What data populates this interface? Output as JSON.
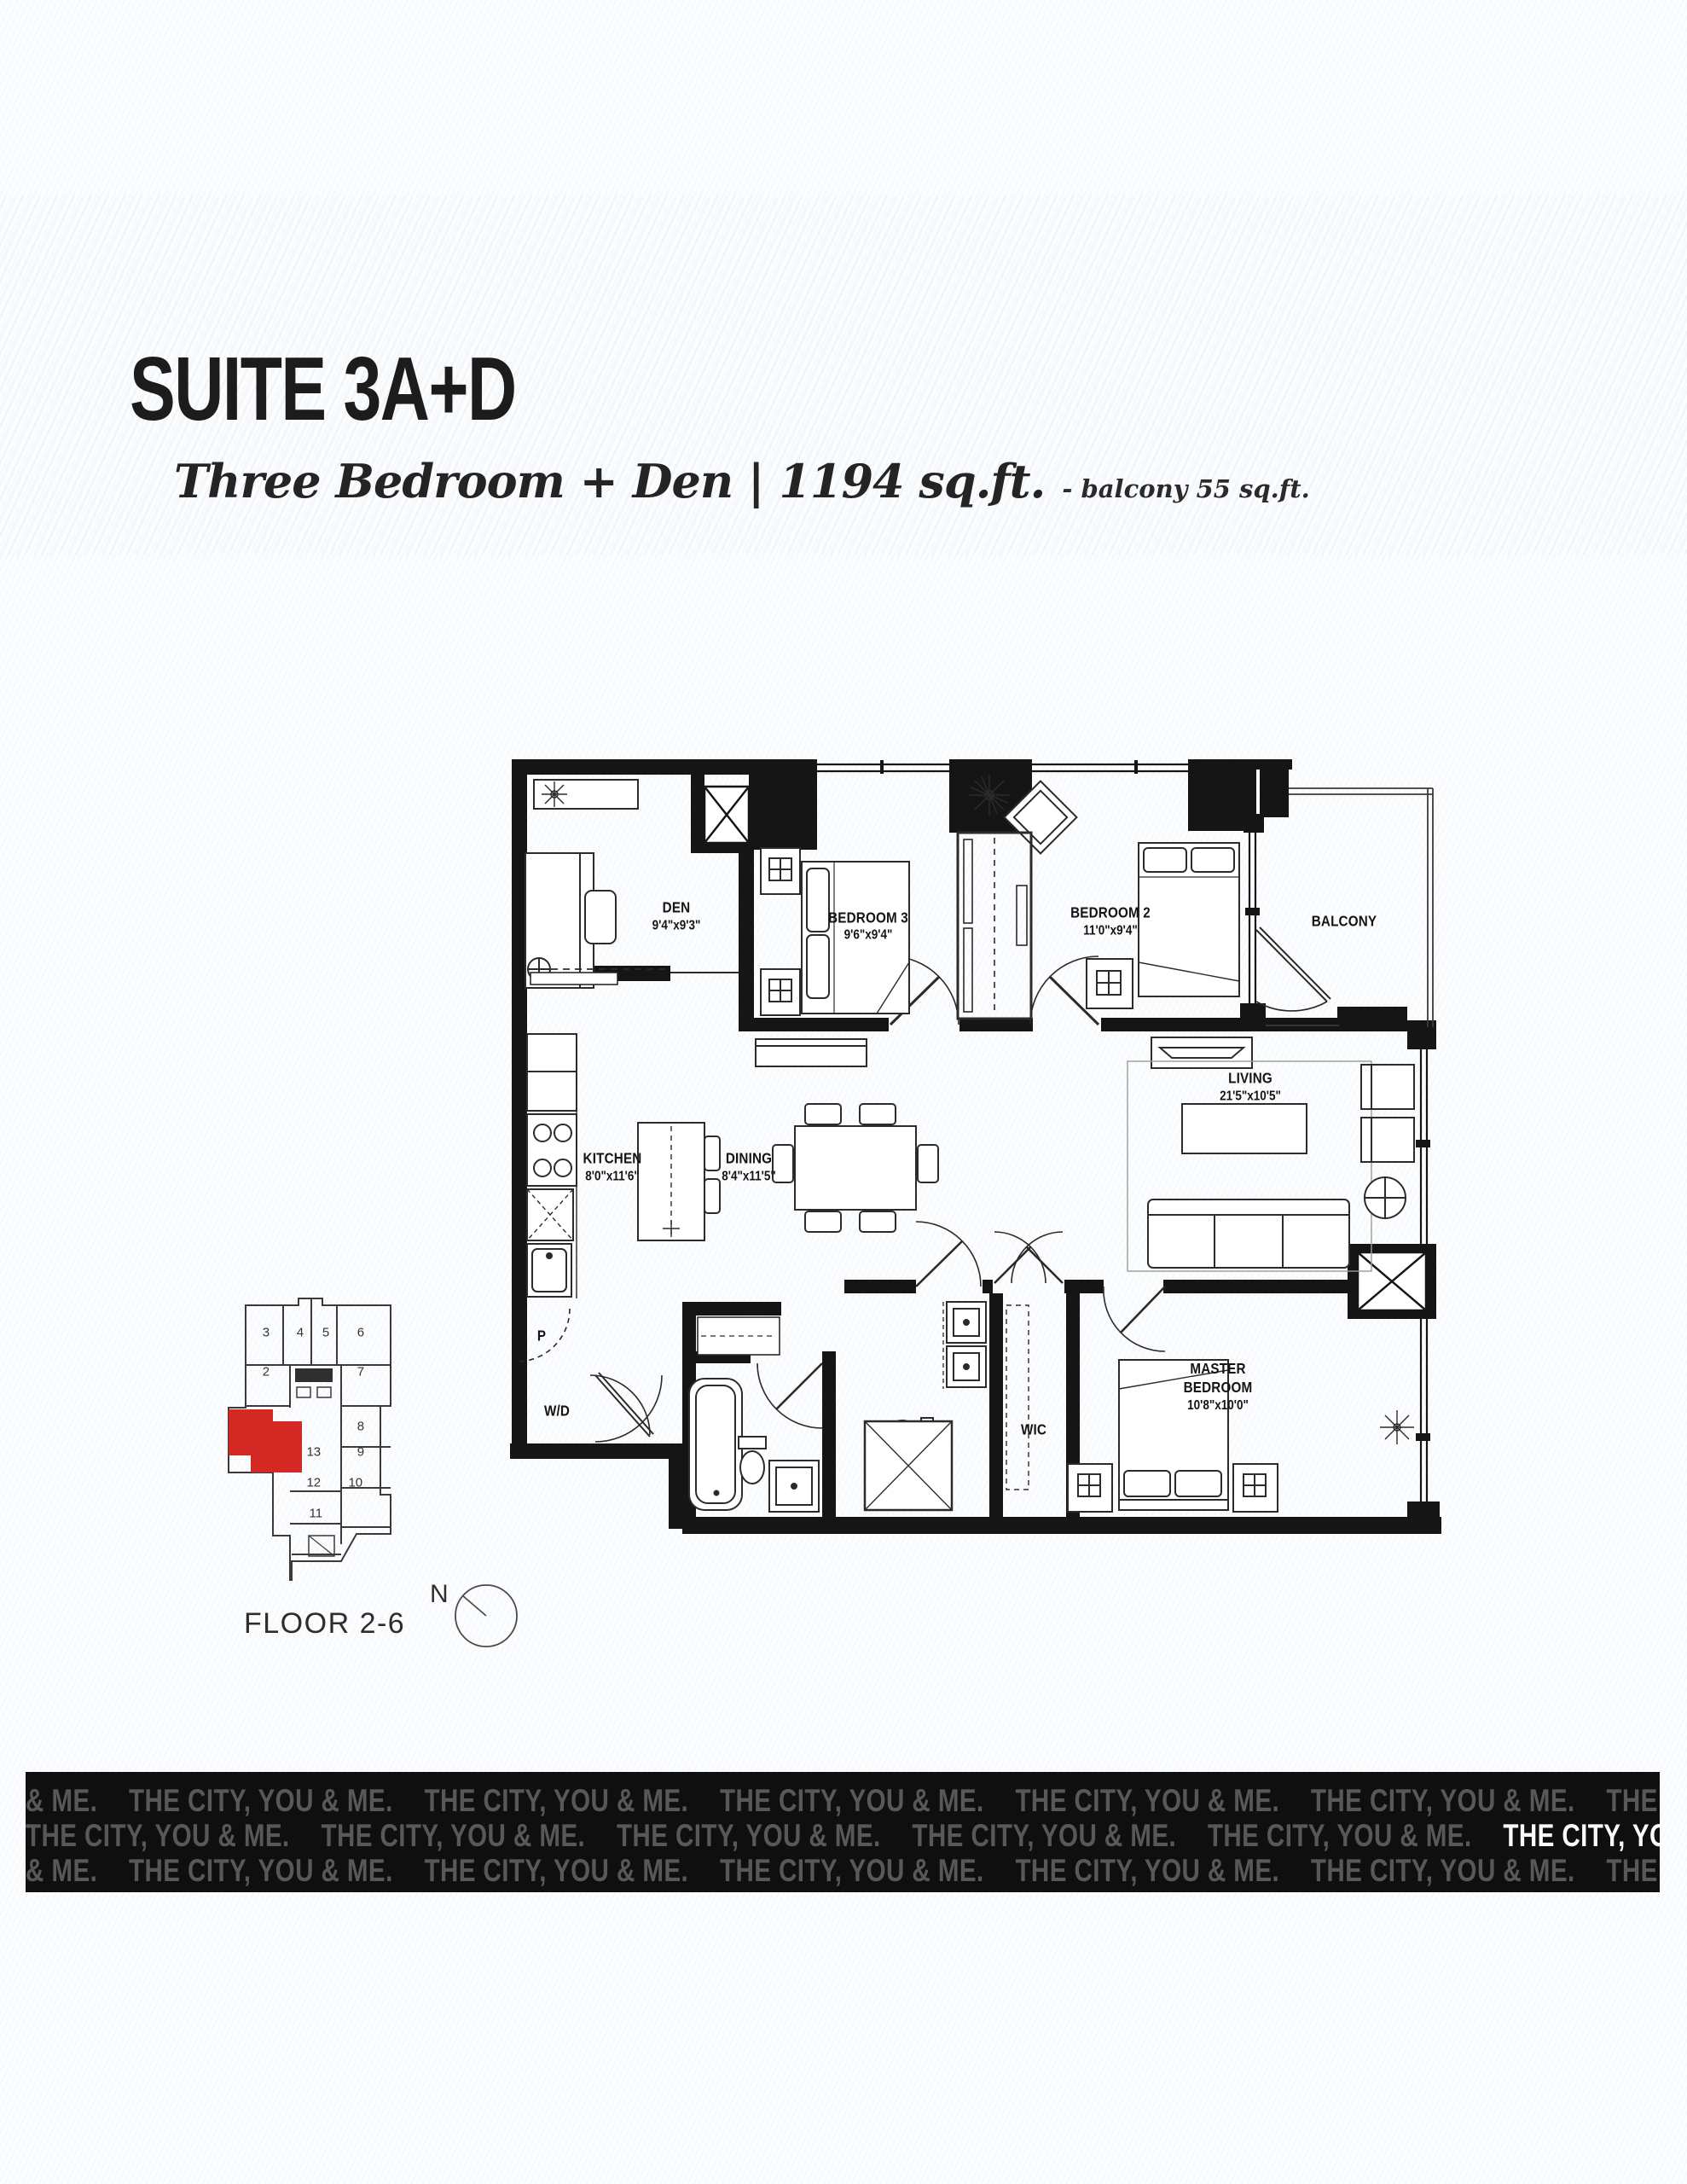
{
  "header": {
    "suite_title": "SUITE 3A+D",
    "subtitle": "Three Bedroom + Den | 1194 sq.ft.",
    "balcony_note": "- balcony 55 sq.ft."
  },
  "plan": {
    "rooms": [
      {
        "name": "DEN",
        "dims": "9'4\"x9'3\"",
        "x": 20.4,
        "y": 25.1
      },
      {
        "name": "BEDROOM 3",
        "dims": "9'6\"x9'4\"",
        "x": 40.2,
        "y": 26.3
      },
      {
        "name": "BEDROOM 2",
        "dims": "11'0\"x9'4\"",
        "x": 65.1,
        "y": 25.7
      },
      {
        "name": "BALCONY",
        "dims": "",
        "x": 89.1,
        "y": 25.7
      },
      {
        "name": "KITCHEN",
        "dims": "8'0\"x11'6\"",
        "x": 13.9,
        "y": 55.1
      },
      {
        "name": "DINING",
        "dims": "8'4\"x11'5\"",
        "x": 27.9,
        "y": 55.1
      },
      {
        "name": "LIVING",
        "dims": "21'5\"x10'5\"",
        "x": 79.5,
        "y": 45.5
      },
      {
        "name": "MASTER BEDROOM",
        "dims": "10'8\"x10'0\"",
        "x": 76.1,
        "y": 81.4
      },
      {
        "name": "WIC",
        "dims": "",
        "x": 57.2,
        "y": 86.5
      },
      {
        "name": "W/D",
        "dims": "",
        "x": 8.2,
        "y": 84.3
      },
      {
        "name": "P",
        "dims": "",
        "x": 6.6,
        "y": 75.3
      }
    ]
  },
  "keyplan": {
    "floor_label": "FLOOR 2-6",
    "north_label": "N",
    "suite_color": "#d42824",
    "units": [
      {
        "t": "3",
        "x": 21.2,
        "y": 15.9
      },
      {
        "t": "4",
        "x": 37.5,
        "y": 15.9
      },
      {
        "t": "5",
        "x": 49.8,
        "y": 15.9
      },
      {
        "t": "6",
        "x": 66.5,
        "y": 15.9
      },
      {
        "t": "2",
        "x": 21.2,
        "y": 27.7
      },
      {
        "t": "7",
        "x": 66.5,
        "y": 27.7
      },
      {
        "t": "8",
        "x": 66.5,
        "y": 44.0
      },
      {
        "t": "13",
        "x": 44.0,
        "y": 51.8
      },
      {
        "t": "9",
        "x": 66.5,
        "y": 51.8
      },
      {
        "t": "12",
        "x": 44.0,
        "y": 61.0
      },
      {
        "t": "10",
        "x": 64.0,
        "y": 61.0
      },
      {
        "t": "11",
        "x": 45.0,
        "y": 70.3
      }
    ]
  },
  "banner": {
    "row1": [
      {
        "t": "& ME."
      },
      {
        "t": "THE CITY, YOU & ME."
      },
      {
        "t": "THE CITY, YOU & ME."
      },
      {
        "t": "THE CITY, YOU & ME."
      },
      {
        "t": "THE CITY, YOU & ME."
      },
      {
        "t": "THE CITY, YOU & ME."
      },
      {
        "t": "THE CITY, YOU & ME."
      },
      {
        "t": "THE CITY,"
      }
    ],
    "row2": [
      {
        "t": "THE CITY, YOU & ME."
      },
      {
        "t": "THE CITY, YOU & ME."
      },
      {
        "t": "THE CITY, YOU & ME."
      },
      {
        "t": "THE CITY, YOU & ME."
      },
      {
        "t": "THE CITY, YOU & ME."
      },
      {
        "t": "THE CITY, YOU & ME.",
        "hl": true
      },
      {
        "t": "THE CITY, YOU & M"
      }
    ],
    "row3": [
      {
        "t": "& ME."
      },
      {
        "t": "THE CITY, YOU & ME."
      },
      {
        "t": "THE CITY, YOU & ME."
      },
      {
        "t": "THE CITY, YOU & ME."
      },
      {
        "t": "THE CITY, YOU & ME."
      },
      {
        "t": "THE CITY, YOU & ME."
      },
      {
        "t": "THE CITY, YOU & ME."
      },
      {
        "t": "THE CI"
      }
    ]
  }
}
